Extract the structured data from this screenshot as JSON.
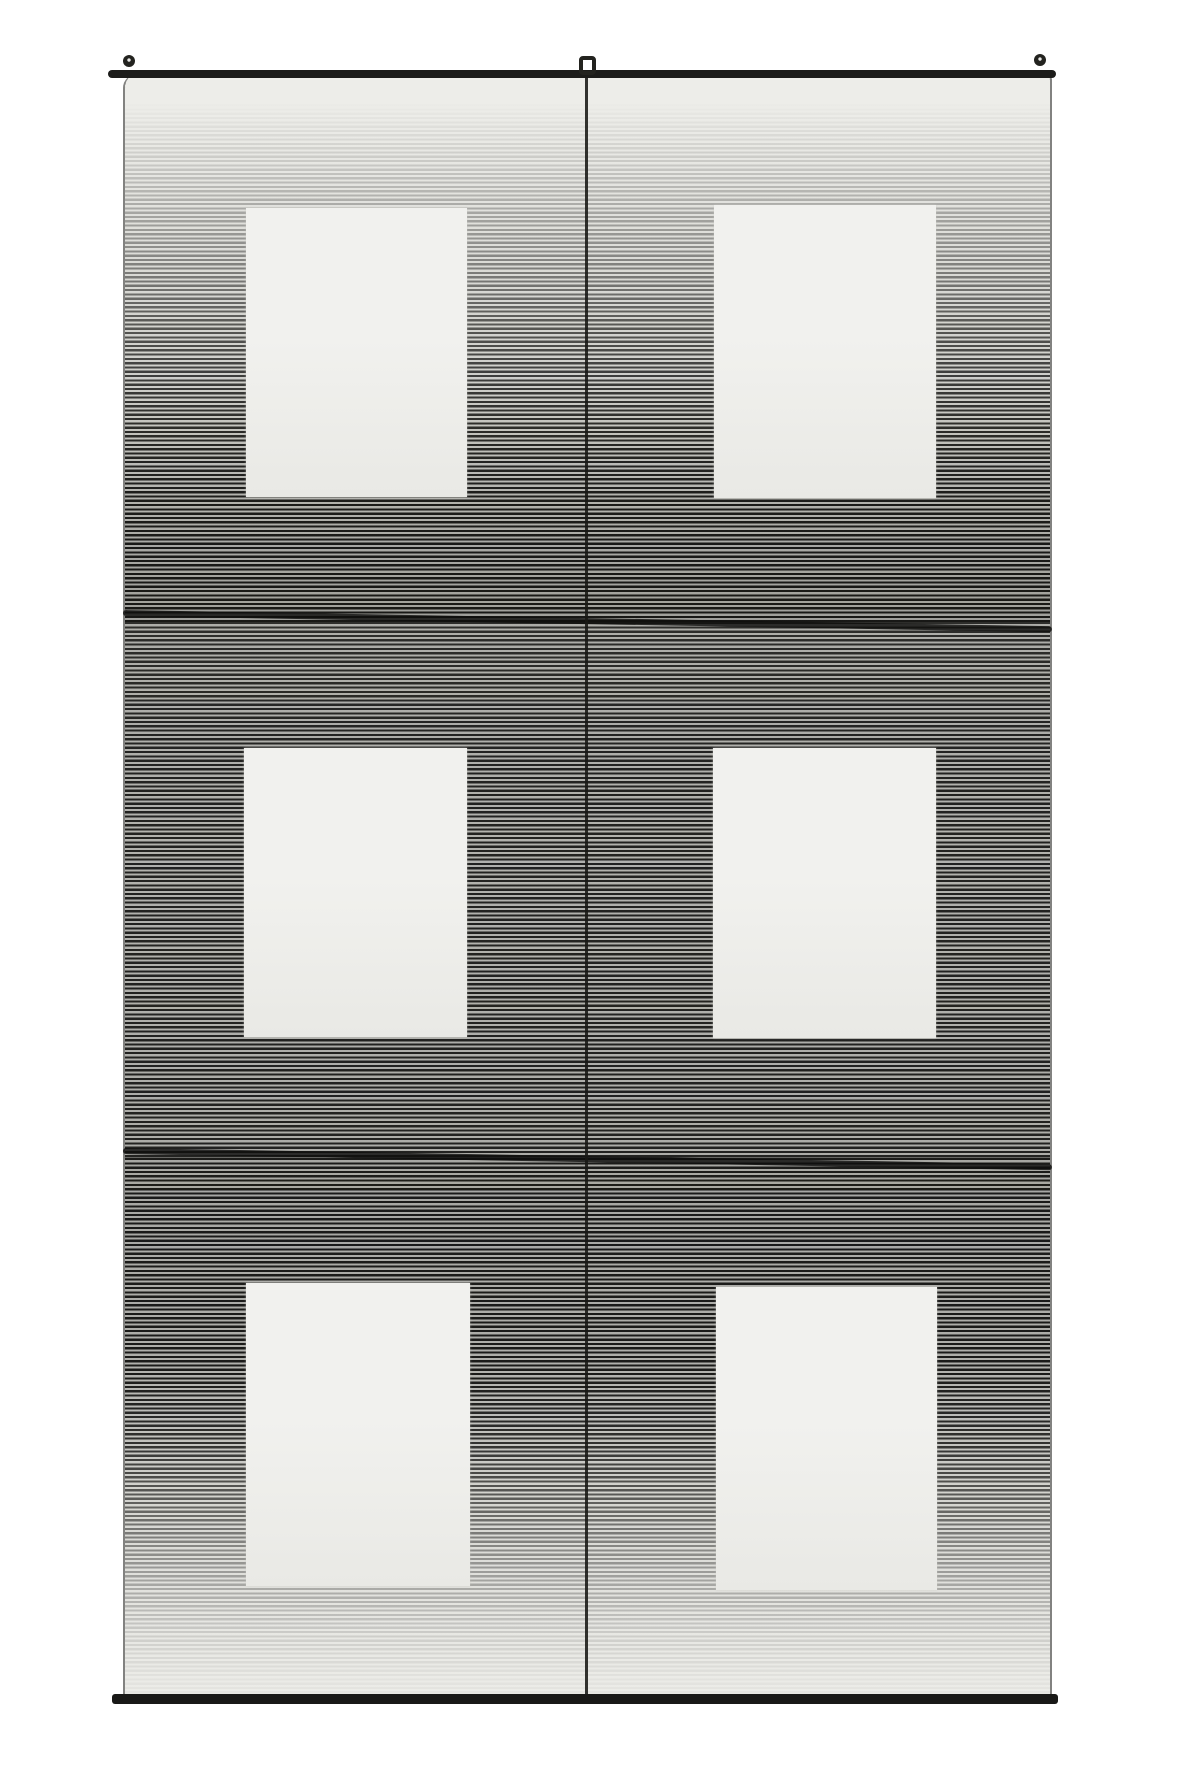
{
  "scene": {
    "description": "Black-and-white photograph of a handwoven textile wall hanging: finely striped fabric in three stitched panels shading from light to dark and back to light, with six plain white rectangular windows in two columns and three rows, a dark center warp line, hung from a thin dark rod with small end knobs and a center loop",
    "canvas": {
      "width": 1181,
      "height": 1772
    },
    "background_color": "#ffffff"
  },
  "textile": {
    "fabric": {
      "x": 123,
      "y": 74,
      "w": 929,
      "h": 1626
    },
    "corner_radius": "14px 6px 3px 3px",
    "edge_color": "rgba(28,28,24,0.55)",
    "stripe": {
      "period_px": 4.3,
      "dark_px": 2.2,
      "dark_color": "#161614",
      "gap_color": "#c8c8c3"
    },
    "panels": [
      {
        "name": "top-panel",
        "h": 548,
        "light_overlay": "linear-gradient(to bottom, rgba(237,237,233,1) 0%, rgba(237,237,233,1) 5%, rgba(237,237,233,0.93) 10%, rgba(237,237,233,0.82) 17%, rgba(237,237,233,0.66) 26%, rgba(237,237,233,0.48) 36%, rgba(237,237,233,0.30) 46%, rgba(237,237,233,0.16) 57%, rgba(237,237,233,0.07) 68%, rgba(237,237,233,0.02) 80%, rgba(237,237,233,0) 100%)",
        "dark_overlay": "linear-gradient(to bottom, rgba(28,28,26,0) 0%, rgba(28,28,26,0) 55%, rgba(28,28,26,0.10) 72%, rgba(28,28,26,0.20) 88%, rgba(28,28,26,0.24) 100%)"
      },
      {
        "name": "middle-panel",
        "h": 536,
        "light_overlay": "linear-gradient(to bottom, rgba(237,237,233,0.10) 0%, rgba(237,237,233,0.05) 30%, rgba(237,237,233,0.05) 100%)",
        "dark_overlay": "linear-gradient(to bottom, rgba(28,28,26,0.20) 0%, rgba(28,28,26,0.15) 40%, rgba(28,28,26,0.18) 100%)"
      },
      {
        "name": "bottom-panel",
        "h": 542,
        "light_overlay": "linear-gradient(to bottom, rgba(237,237,233,0.02) 0%, rgba(237,237,233,0.02) 40%, rgba(237,237,233,0.12) 52%, rgba(237,237,233,0.35) 64%, rgba(237,237,233,0.62) 76%, rgba(237,237,233,0.85) 88%, rgba(237,237,233,0.95) 96%, rgba(237,237,233,0.97) 100%)",
        "dark_overlay": "linear-gradient(to bottom, rgba(28,28,26,0.20) 0%, rgba(28,28,26,0.16) 35%, rgba(28,28,26,0.08) 50%, rgba(28,28,26,0) 62%, rgba(28,28,26,0) 100%)"
      }
    ],
    "seams": [
      {
        "x": 123,
        "y": 610,
        "w": 929,
        "h": 6,
        "rotate_deg": 1.0,
        "color": "rgba(15,15,13,0.82)"
      },
      {
        "x": 123,
        "y": 1148,
        "w": 929,
        "h": 6,
        "rotate_deg": 1.0,
        "color": "rgba(15,15,13,0.82)"
      }
    ],
    "center_line": {
      "x": 585,
      "y": 78,
      "w": 3,
      "h": 1622,
      "color": "rgba(24,24,20,0.88)"
    },
    "rod": {
      "x": 108,
      "y": 70,
      "w": 948,
      "h": 8,
      "color": "#1c1c1a"
    },
    "bottom_hem": {
      "x": 112,
      "y": 1694,
      "w": 946,
      "h": 10,
      "color": "#191917"
    },
    "knobs": [
      {
        "name": "rod-knob-left",
        "cx": 129,
        "cy": 61,
        "r": 6
      },
      {
        "name": "rod-knob-right",
        "cx": 1040,
        "cy": 60,
        "r": 6
      }
    ],
    "knob_color": "#23231f",
    "knob_center_color": "#e8e8e6",
    "hanging_loop": {
      "x": 579,
      "y": 56,
      "w": 17,
      "h": 19,
      "border_px": 4,
      "color": "#23231f"
    },
    "rect_fill_top": "#f1f1ee",
    "rect_fill_bottom": "#e9e9e5",
    "rectangles": [
      {
        "row": 1,
        "col": 1,
        "x": 246,
        "y": 208,
        "w": 221,
        "h": 289
      },
      {
        "row": 1,
        "col": 2,
        "x": 714,
        "y": 205,
        "w": 222,
        "h": 293
      },
      {
        "row": 2,
        "col": 1,
        "x": 244,
        "y": 748,
        "w": 223,
        "h": 289
      },
      {
        "row": 2,
        "col": 2,
        "x": 713,
        "y": 748,
        "w": 223,
        "h": 290
      },
      {
        "row": 3,
        "col": 1,
        "x": 246,
        "y": 1283,
        "w": 224,
        "h": 303
      },
      {
        "row": 3,
        "col": 2,
        "x": 716,
        "y": 1287,
        "w": 221,
        "h": 303
      }
    ]
  }
}
